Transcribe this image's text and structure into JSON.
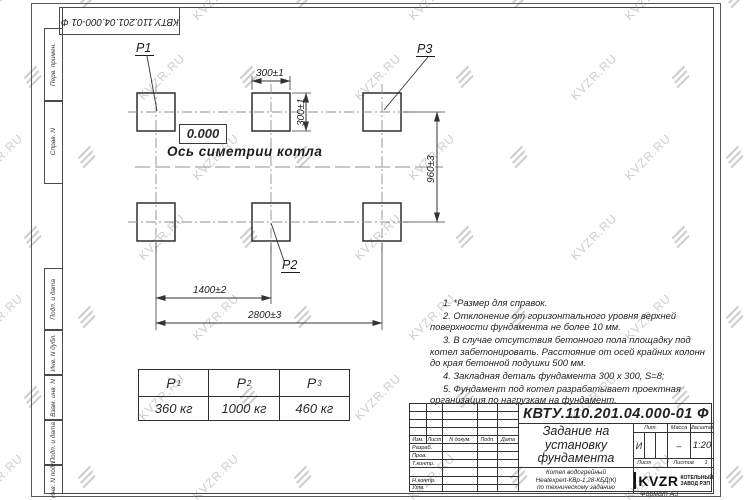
{
  "sheet": {
    "doc_number_top": "КВТУ.110.201.04.000-01 Ф",
    "watermark_text": "KVZR.RU",
    "format_label": "Формат А3"
  },
  "side_strip": {
    "labels": [
      "Перв. примен.",
      "Справ. N",
      "Подп. и дата",
      "Инв. N дубл.",
      "Взам. инв. N",
      "Подп. и дата",
      "Инв. N подл."
    ]
  },
  "drawing": {
    "pads": {
      "p1": "P1",
      "p2": "P2",
      "p3": "P3"
    },
    "elevation": "0.000",
    "axis_label": "Ось симетрии котла",
    "dims": {
      "pad_width": "300±1",
      "pad_height": "300±1",
      "row_spacing": "960±3",
      "mid_spacing": "1400±2",
      "total_spacing": "2800±3"
    }
  },
  "loads_table": {
    "columns": [
      {
        "symbol": "P",
        "sub": "1",
        "value": "360 кг"
      },
      {
        "symbol": "P",
        "sub": "2",
        "value": "1000 кг"
      },
      {
        "symbol": "P",
        "sub": "3",
        "value": "460 кг"
      }
    ]
  },
  "notes": [
    "1. *Размер для справок.",
    "2. Отклонение от горизонтального уровня верхней поверхности фундамента не более 10 мм.",
    "3. В случае отсутствия бетонного пола площадку под котел забетонировать. Расстояние от осей крайних колонн до края бетонной подушки 500 мм.",
    "4. Закладная деталь фундамента  300 х 300, S=8;",
    "5. Фундамент под котел разрабатывает проектная организация по нагрузкам на фундамент."
  ],
  "title_block": {
    "doc_number": "КВТУ.110.201.04.000-01 Ф",
    "title_lines": [
      "Задание на",
      "установку",
      "фундамента"
    ],
    "subject_lines": [
      "Котел водогрейный",
      "Heatexpert-КВр-1,28-КБД(К)",
      "по техническому заданию"
    ],
    "header_cols": [
      "Изм.",
      "Лист",
      "N докум.",
      "Подп.",
      "Дата"
    ],
    "row_labels": [
      "Разраб.",
      "Пров.",
      "Т.контр.",
      "",
      "Н.контр.",
      "Утв."
    ],
    "lit_label": "Лит.",
    "mass_label": "Масса",
    "scale_label": "Масштаб",
    "lit_value": "И",
    "mass_value": "–",
    "scale_value": "1:20",
    "sheet_label": "Лист",
    "sheets_label": "Листов",
    "sheets_value": "1",
    "logo_text": "KVZR",
    "company_line1": "КОТЕЛЬНЫЙ",
    "company_line2": "ЗАВОД РЭП"
  }
}
